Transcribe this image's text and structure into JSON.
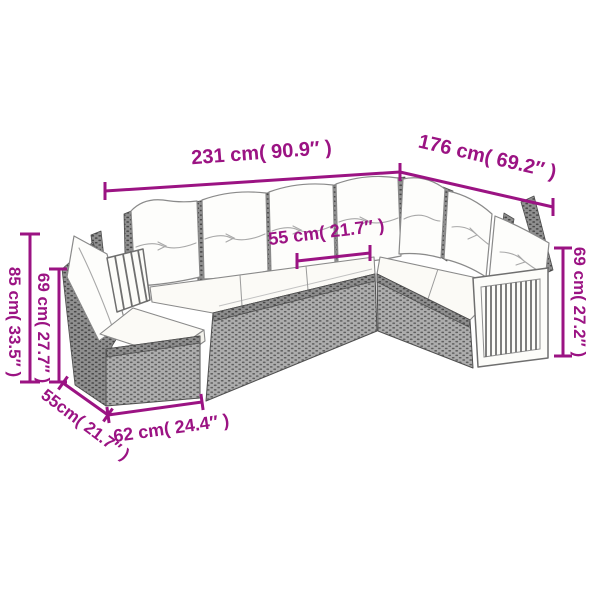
{
  "diagram": {
    "accent_color": "#9b1383",
    "colors": {
      "rattan_gray": "#adadad",
      "rattan_dark": "#5d5d5d",
      "cushion_white": "#fdfdfb",
      "outline_gray": "#8a8a8a"
    },
    "labels": {
      "top_width": "231 cm( 90.9″ )",
      "side_depth": "176 cm( 69.2″ )",
      "seat_width": "55 cm( 21.7″ )",
      "total_height": "85 cm( 33.5″ )",
      "back_height": "69 cm( 27.7″ )",
      "armrest_height": "69 cm( 27.2″ )",
      "module_depth": "55cm( 21.7″ )",
      "module_width": "62 cm( 24.4″ )"
    }
  }
}
